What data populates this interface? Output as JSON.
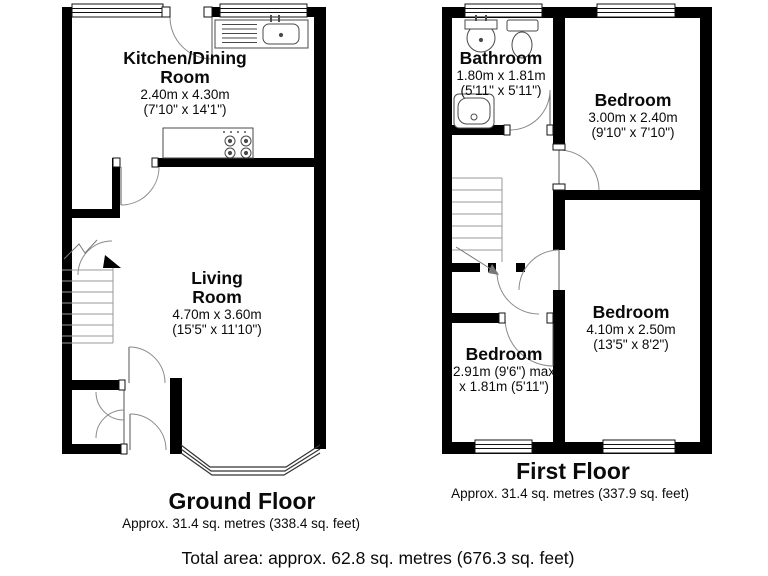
{
  "document": {
    "type": "floorplan",
    "background": "#ffffff"
  },
  "colors": {
    "wall": "#000000",
    "fixture_line": "#4a4a4a",
    "door_arc": "#8a8a8a",
    "text": "#0a0a0a",
    "background": "#ffffff"
  },
  "fixtures": [
    "kitchen-sink",
    "stove",
    "bathroom-sink",
    "toilet",
    "shower",
    "staircase",
    "bay-window"
  ],
  "rooms": {
    "kitchen": {
      "line1": "Kitchen/Dining",
      "line2": "Room",
      "dim_m": "2.40m x 4.30m",
      "dim_ft": "(7'10\" x 14'1\")"
    },
    "living": {
      "line1": "Living",
      "line2": "Room",
      "dim_m": "4.70m x 3.60m",
      "dim_ft": "(15'5\" x 11'10\")"
    },
    "bathroom": {
      "line1": "Bathroom",
      "dim_m": "1.80m x 1.81m",
      "dim_ft": "(5'11\" x 5'11\")"
    },
    "bedroom_front": {
      "line1": "Bedroom",
      "dim_m": "3.00m x 2.40m",
      "dim_ft": "(9'10\" x 7'10\")"
    },
    "bedroom_rear": {
      "line1": "Bedroom",
      "dim_m": "4.10m x 2.50m",
      "dim_ft": "(13'5\" x 8'2\")"
    },
    "bedroom_small": {
      "line1": "Bedroom",
      "dim_m": "2.91m (9'6\") max",
      "dim_ft": "x 1.81m (5'11\")"
    }
  },
  "floors": {
    "ground": {
      "title": "Ground Floor",
      "area": "Approx. 31.4 sq. metres (338.4 sq. feet)"
    },
    "first": {
      "title": "First Floor",
      "area": "Approx. 31.4 sq. metres (337.9 sq. feet)"
    }
  },
  "total": {
    "label": "Total area: approx. 62.8 sq. metres (676.3 sq. feet)"
  }
}
